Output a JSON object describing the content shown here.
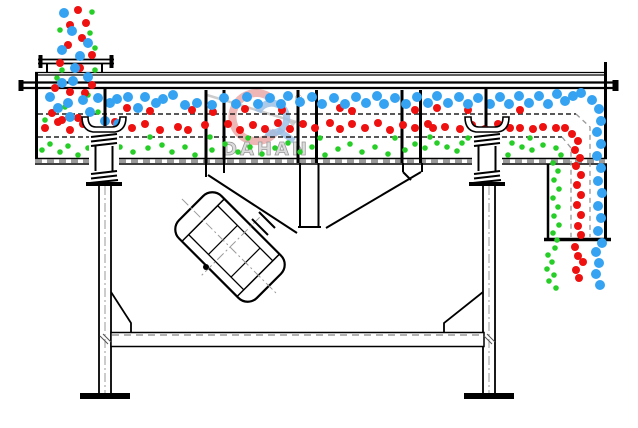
{
  "watermark": {
    "brand": "DAHAN",
    "registered": "®"
  },
  "colors": {
    "line": "#000000",
    "coarse_particle_blue": "#35A3F1",
    "medium_particle_red": "#EF1010",
    "fine_particle_green": "#27CE27",
    "watermark_gray": "#b5b5b5",
    "watermark_red": "#e89a9a",
    "watermark_blue": "#93b9e2"
  },
  "particles": {
    "blue": {
      "color": "#35A3F1",
      "r": 5,
      "points": [
        [
          64,
          13
        ],
        [
          72,
          31
        ],
        [
          62,
          50
        ],
        [
          80,
          56
        ],
        [
          88,
          43
        ],
        [
          75,
          68
        ],
        [
          88,
          77
        ],
        [
          62,
          83
        ],
        [
          73,
          81
        ],
        [
          50,
          97
        ],
        [
          68,
          103
        ],
        [
          83,
          100
        ],
        [
          58,
          108
        ],
        [
          70,
          117
        ],
        [
          90,
          112
        ],
        [
          105,
          121
        ],
        [
          118,
          124
        ],
        [
          98,
          98
        ],
        [
          110,
          103
        ],
        [
          117,
          99
        ],
        [
          128,
          97
        ],
        [
          138,
          108
        ],
        [
          145,
          97
        ],
        [
          156,
          103
        ],
        [
          163,
          99
        ],
        [
          173,
          95
        ],
        [
          185,
          105
        ],
        [
          197,
          103
        ],
        [
          212,
          105
        ],
        [
          224,
          98
        ],
        [
          236,
          104
        ],
        [
          247,
          97
        ],
        [
          258,
          104
        ],
        [
          270,
          98
        ],
        [
          281,
          104
        ],
        [
          288,
          96
        ],
        [
          300,
          102
        ],
        [
          312,
          97
        ],
        [
          322,
          104
        ],
        [
          334,
          98
        ],
        [
          345,
          104
        ],
        [
          356,
          97
        ],
        [
          366,
          103
        ],
        [
          377,
          96
        ],
        [
          384,
          104
        ],
        [
          395,
          98
        ],
        [
          406,
          104
        ],
        [
          417,
          97
        ],
        [
          428,
          103
        ],
        [
          437,
          96
        ],
        [
          448,
          103
        ],
        [
          459,
          97
        ],
        [
          468,
          104
        ],
        [
          478,
          98
        ],
        [
          490,
          104
        ],
        [
          500,
          97
        ],
        [
          509,
          104
        ],
        [
          519,
          96
        ],
        [
          529,
          103
        ],
        [
          539,
          96
        ],
        [
          548,
          104
        ],
        [
          557,
          94
        ],
        [
          565,
          101
        ],
        [
          573,
          96
        ],
        [
          581,
          93
        ],
        [
          592,
          100
        ],
        [
          599,
          109
        ],
        [
          601,
          121
        ],
        [
          597,
          132
        ],
        [
          601,
          144
        ],
        [
          597,
          156
        ],
        [
          601,
          168
        ],
        [
          598,
          181
        ],
        [
          602,
          193
        ],
        [
          598,
          206
        ],
        [
          601,
          218
        ],
        [
          598,
          231
        ],
        [
          602,
          243
        ],
        [
          596,
          252
        ],
        [
          599,
          263
        ],
        [
          596,
          274
        ],
        [
          600,
          285
        ]
      ]
    },
    "red": {
      "color": "#EF1010",
      "r": 4,
      "points": [
        [
          78,
          10
        ],
        [
          86,
          23
        ],
        [
          70,
          25
        ],
        [
          82,
          38
        ],
        [
          92,
          55
        ],
        [
          68,
          45
        ],
        [
          60,
          63
        ],
        [
          80,
          68
        ],
        [
          92,
          85
        ],
        [
          55,
          88
        ],
        [
          70,
          92
        ],
        [
          85,
          93
        ],
        [
          52,
          113
        ],
        [
          62,
          120
        ],
        [
          78,
          118
        ],
        [
          127,
          108
        ],
        [
          150,
          111
        ],
        [
          192,
          110
        ],
        [
          213,
          112
        ],
        [
          245,
          109
        ],
        [
          282,
          110
        ],
        [
          340,
          108
        ],
        [
          352,
          111
        ],
        [
          415,
          110
        ],
        [
          437,
          108
        ],
        [
          468,
          110
        ],
        [
          520,
          110
        ],
        [
          45,
          128
        ],
        [
          58,
          122
        ],
        [
          70,
          130
        ],
        [
          83,
          124
        ],
        [
          100,
          131
        ],
        [
          115,
          122
        ],
        [
          132,
          128
        ],
        [
          145,
          124
        ],
        [
          160,
          130
        ],
        [
          178,
          127
        ],
        [
          188,
          130
        ],
        [
          205,
          125
        ],
        [
          228,
          124
        ],
        [
          240,
          130
        ],
        [
          253,
          125
        ],
        [
          265,
          129
        ],
        [
          278,
          123
        ],
        [
          290,
          129
        ],
        [
          303,
          124
        ],
        [
          315,
          128
        ],
        [
          330,
          123
        ],
        [
          340,
          129
        ],
        [
          352,
          124
        ],
        [
          365,
          128
        ],
        [
          378,
          123
        ],
        [
          390,
          130
        ],
        [
          403,
          125
        ],
        [
          415,
          128
        ],
        [
          428,
          124
        ],
        [
          433,
          128
        ],
        [
          445,
          127
        ],
        [
          460,
          129
        ],
        [
          472,
          125
        ],
        [
          485,
          129
        ],
        [
          498,
          124
        ],
        [
          510,
          128
        ],
        [
          520,
          128
        ],
        [
          533,
          129
        ],
        [
          543,
          127
        ],
        [
          556,
          128
        ],
        [
          565,
          128
        ],
        [
          572,
          134
        ],
        [
          578,
          141
        ],
        [
          575,
          150
        ],
        [
          580,
          158
        ],
        [
          576,
          166
        ],
        [
          581,
          175
        ],
        [
          577,
          185
        ],
        [
          581,
          195
        ],
        [
          577,
          205
        ],
        [
          581,
          215
        ],
        [
          578,
          226
        ],
        [
          581,
          235
        ],
        [
          575,
          247
        ],
        [
          578,
          256
        ],
        [
          583,
          262
        ],
        [
          576,
          270
        ],
        [
          579,
          278
        ]
      ]
    },
    "green": {
      "color": "#27CE27",
      "r": 2.8,
      "points": [
        [
          92,
          12
        ],
        [
          60,
          30
        ],
        [
          90,
          33
        ],
        [
          95,
          48
        ],
        [
          62,
          70
        ],
        [
          95,
          70
        ],
        [
          57,
          78
        ],
        [
          88,
          95
        ],
        [
          65,
          107
        ],
        [
          98,
          112
        ],
        [
          45,
          120
        ],
        [
          105,
          135
        ],
        [
          150,
          137
        ],
        [
          210,
          137
        ],
        [
          248,
          138
        ],
        [
          320,
          138
        ],
        [
          395,
          138
        ],
        [
          430,
          137
        ],
        [
          468,
          138
        ],
        [
          530,
          138
        ],
        [
          42,
          150
        ],
        [
          50,
          144
        ],
        [
          60,
          152
        ],
        [
          68,
          146
        ],
        [
          78,
          155
        ],
        [
          88,
          148
        ],
        [
          98,
          143
        ],
        [
          108,
          153
        ],
        [
          120,
          147
        ],
        [
          133,
          152
        ],
        [
          148,
          148
        ],
        [
          162,
          145
        ],
        [
          172,
          152
        ],
        [
          185,
          147
        ],
        [
          195,
          155
        ],
        [
          212,
          150
        ],
        [
          225,
          144
        ],
        [
          238,
          152
        ],
        [
          250,
          147
        ],
        [
          262,
          154
        ],
        [
          275,
          148
        ],
        [
          288,
          143
        ],
        [
          300,
          152
        ],
        [
          312,
          147
        ],
        [
          325,
          155
        ],
        [
          338,
          149
        ],
        [
          350,
          144
        ],
        [
          362,
          152
        ],
        [
          375,
          147
        ],
        [
          388,
          154
        ],
        [
          405,
          150
        ],
        [
          415,
          144
        ],
        [
          425,
          148
        ],
        [
          437,
          143
        ],
        [
          447,
          147
        ],
        [
          457,
          151
        ],
        [
          462,
          143
        ],
        [
          478,
          147
        ],
        [
          490,
          143
        ],
        [
          498,
          148
        ],
        [
          508,
          155
        ],
        [
          512,
          143
        ],
        [
          522,
          147
        ],
        [
          532,
          150
        ],
        [
          543,
          145
        ],
        [
          556,
          148
        ],
        [
          561,
          155
        ],
        [
          553,
          163
        ],
        [
          558,
          171
        ],
        [
          554,
          180
        ],
        [
          559,
          189
        ],
        [
          553,
          198
        ],
        [
          558,
          207
        ],
        [
          554,
          216
        ],
        [
          559,
          225
        ],
        [
          553,
          233
        ],
        [
          557,
          240
        ],
        [
          555,
          248
        ],
        [
          548,
          255
        ],
        [
          552,
          262
        ],
        [
          547,
          269
        ],
        [
          554,
          275
        ],
        [
          549,
          281
        ],
        [
          556,
          288
        ]
      ]
    }
  }
}
